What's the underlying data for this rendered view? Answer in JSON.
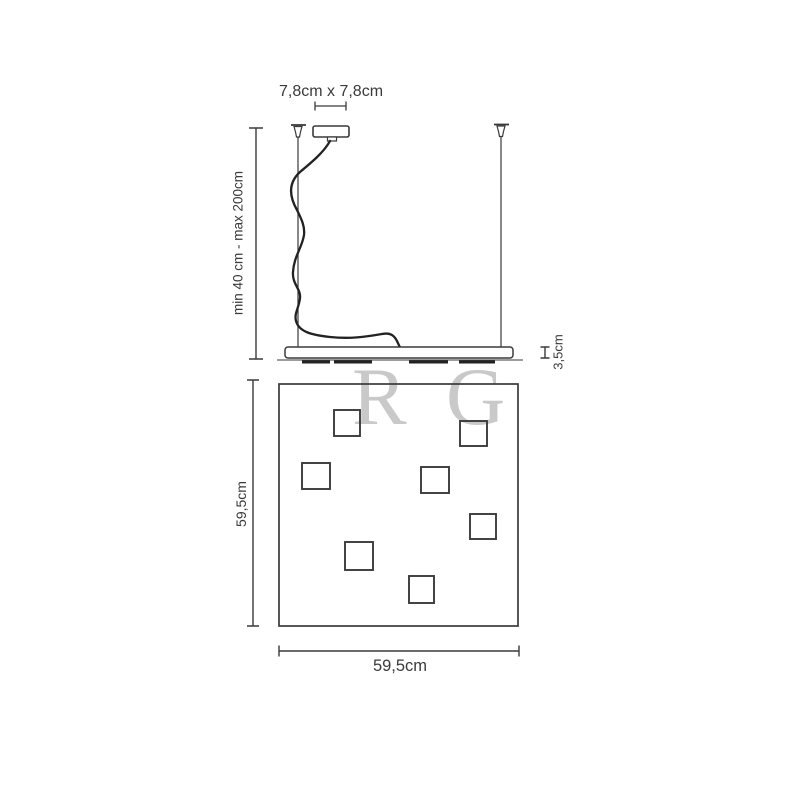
{
  "diagram": {
    "type": "pendant-lamp-dimension-drawing",
    "labels": {
      "canopy_size": "7,8cm x 7,8cm",
      "suspension_range": "min 40 cm - max 200cm",
      "panel_thickness": "3,5cm",
      "panel_depth": "59,5cm",
      "panel_width": "59,5cm"
    },
    "watermark": {
      "letters": [
        "R",
        "G"
      ],
      "color": "#c9c9c9"
    },
    "colors": {
      "line": "#3a3a3a",
      "cord": "#222222",
      "background": "#ffffff"
    },
    "led_square_count": 7
  }
}
